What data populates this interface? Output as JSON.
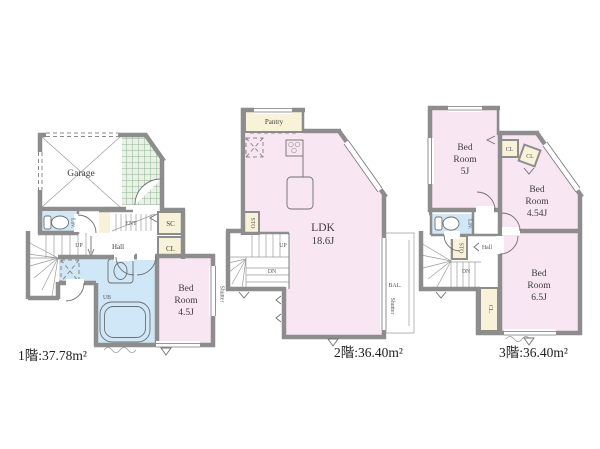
{
  "colors": {
    "wall": "#8d8d8d",
    "pink": "#f9e6f3",
    "yellow": "#f8f3d8",
    "blue": "#cfe7f6",
    "porch_bg": "#eaf2e7",
    "porch_line": "#8ab891",
    "ink": "#3d3d3d"
  },
  "floor1": {
    "caption": "1階:37.78m²",
    "garage": "Garage",
    "lav": "Lav.",
    "ent": "ENT",
    "sc": "SC",
    "cl": "CL",
    "hall": "Hall",
    "up": "UP",
    "ub": "UB",
    "bedroom": [
      "Bed",
      "Room",
      "4.5J"
    ],
    "shutter": "Shutter"
  },
  "floor2": {
    "caption": "2階:36.40m²",
    "pantry": "Pantry",
    "sto": "STO",
    "up": "UP",
    "dn": "DN",
    "ldk": [
      "LDK",
      "18.6J"
    ],
    "bal": "BAL.",
    "shutter": "Shutter"
  },
  "floor3": {
    "caption": "3階:36.40m²",
    "bedroom5": [
      "Bed",
      "Room",
      "5J"
    ],
    "bedroom454": [
      "Bed",
      "Room",
      "4.54J"
    ],
    "bedroom65": [
      "Bed",
      "Room",
      "6.5J"
    ],
    "cl1": "CL",
    "cl2": "CL",
    "cl3": "CL.",
    "lav": "Lav.",
    "sto": "STO",
    "hall": "Hall",
    "dn": "DN"
  }
}
